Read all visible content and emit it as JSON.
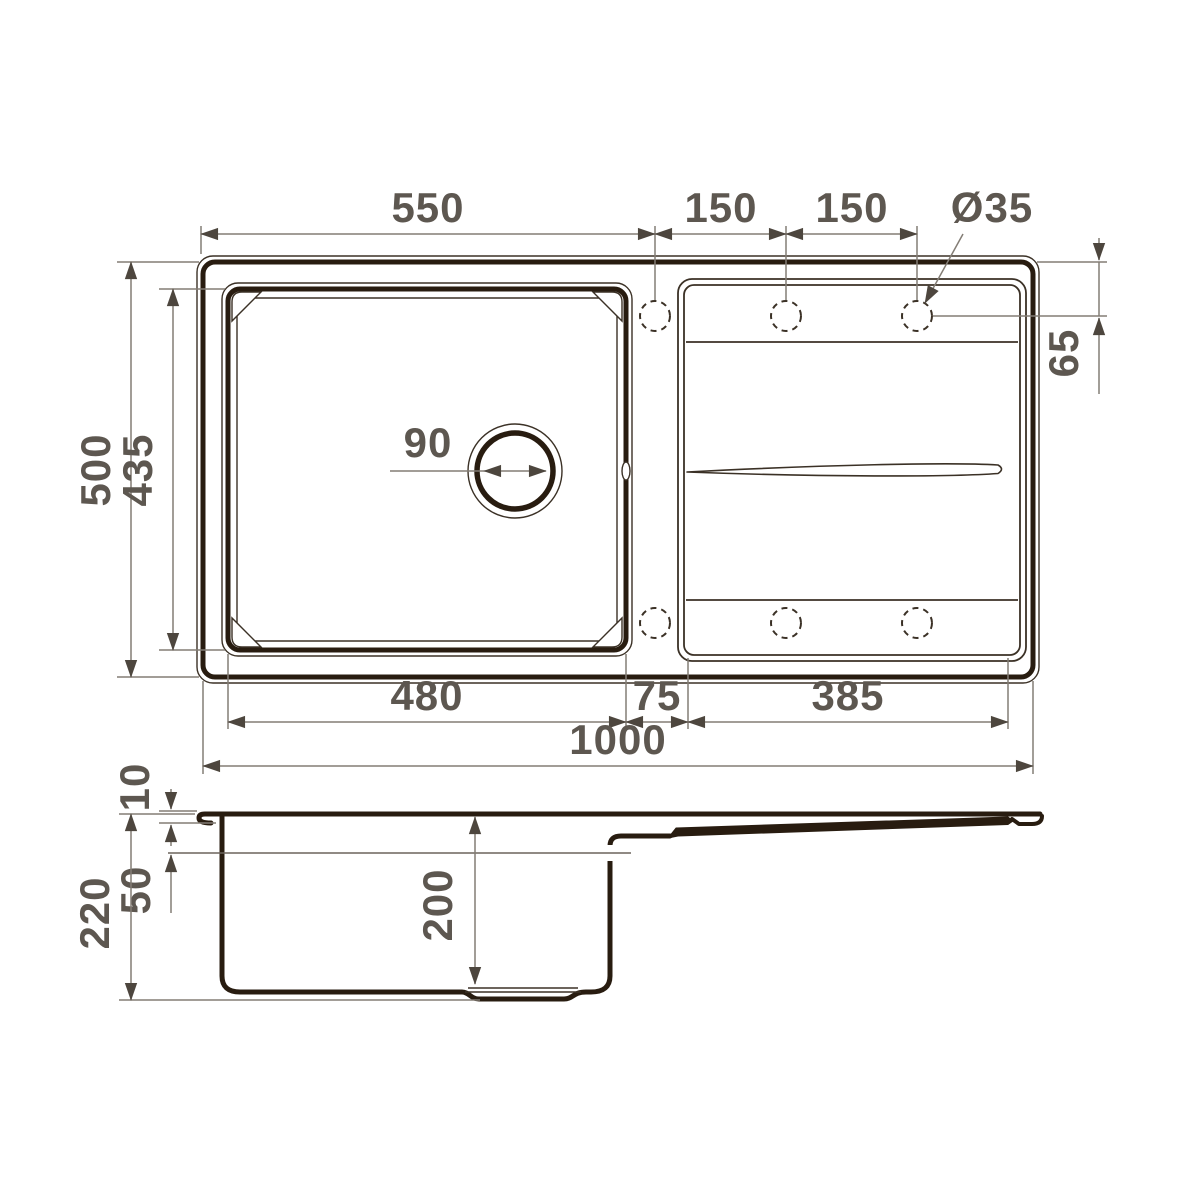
{
  "drawing": {
    "title": "sink-dimension-drawing",
    "top_view": {
      "width_edge_to_first_hole": "550",
      "hole_pitch_1": "150",
      "hole_pitch_2": "150",
      "faucet_hole_diameter": "Ø35",
      "hole_offset_from_edge": "65",
      "overall_depth": "500",
      "bowl_outer_depth": "435",
      "drain_diameter": "90",
      "bowl_outer_width": "480",
      "ledge_width": "75",
      "drainboard_width": "385",
      "overall_width": "1000"
    },
    "side_view": {
      "rim_lip_height": "10",
      "overflow_level": "50",
      "overall_height": "220",
      "bowl_depth": "200"
    },
    "colors": {
      "ink": "#281c10",
      "dimension_line": "#837d75",
      "label_text": "#5d5750",
      "background": "#ffffff"
    }
  }
}
